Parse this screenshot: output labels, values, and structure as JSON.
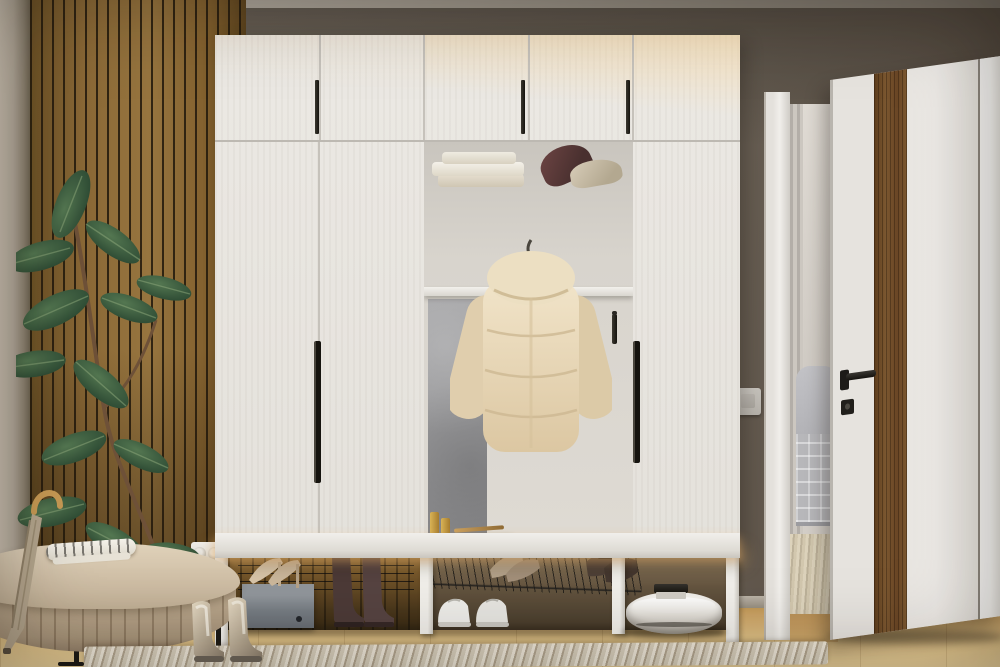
{
  "meta": {
    "type": "interior-photograph",
    "description": "Entryway hallway render: white hall wardrobe with open niche, wood slat accent wall, rubber plant, upholstered bench, shoes, robot vacuum and open white door with wood inlay",
    "width": 1000,
    "height": 667
  },
  "palette": {
    "wall_taupe": "#6e655a",
    "ceiling_grey": "#a8a198",
    "wood_slats": "#8a6836",
    "wardrobe_white": "#e9e6e1",
    "warm_led_glow": "#f6d9a4",
    "handle_black": "#16140f",
    "niche_grey_panel": "#9a9a9c",
    "jacket_beige": "#e7d9bd",
    "basket_wicker": "#b08b53",
    "floor_oak": "#cda568",
    "rug_weave": "#d9d0bf",
    "plant_green": "#33503a",
    "door_white": "#e9e6e1",
    "door_wood_inlay": "#6b4722",
    "sofa_grey": "#b0b0b4",
    "bench_beige": "#c3b096"
  },
  "wardrobe": {
    "basket_label": "MERESON",
    "top_door_count": 5,
    "hook_count": 4,
    "niche_items": [
      "folded towels",
      "burgundy cap",
      "beige cap",
      "puffer jacket",
      "drawer unit",
      "perfume bottles",
      "wicker basket",
      "tote bag"
    ]
  },
  "scene_objects": [
    "wood-slat-accent-wall",
    "rubber-plant",
    "upholstered-bench",
    "umbrella",
    "folded-clothes",
    "power-socket",
    "hall-wardrobe",
    "puffer-jacket",
    "tote-bag",
    "wicker-basket",
    "shoe-box",
    "beige-heels",
    "brown-ankle-boots",
    "white-sneakers",
    "wire-shoe-rack",
    "robot-vacuum",
    "light-switch",
    "open-door",
    "door-handle",
    "living-room-sofa",
    "wood-floor",
    "woven-rug",
    "metallic-chelsea-boots"
  ]
}
